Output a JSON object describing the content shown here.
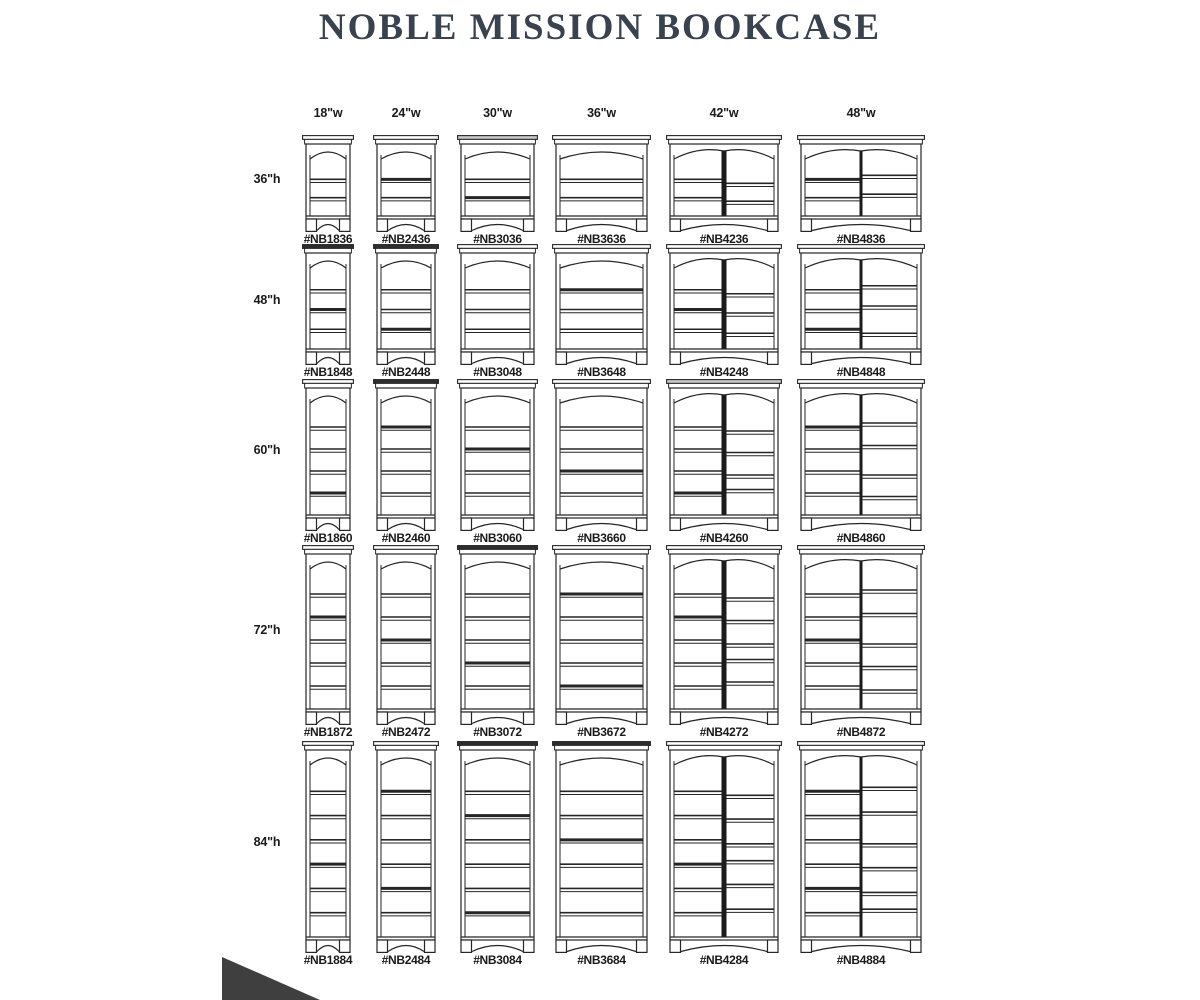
{
  "page": {
    "title": "NOBLE MISSION BOOKCASE",
    "colors": {
      "title": "#39424f",
      "line": "#262626",
      "text": "#1a1a1a",
      "crown_white": "#ffffff",
      "crown_gray": "#c9c9c9",
      "crown_dark": "#2e2e2e",
      "divider": "#1b1b1b",
      "corner_mark": "#3f3f3f",
      "background": "#ffffff"
    }
  },
  "grid": {
    "columns": [
      {
        "label": "18\"w",
        "width_in": 18,
        "divided": false
      },
      {
        "label": "24\"w",
        "width_in": 24,
        "divided": false
      },
      {
        "label": "30\"w",
        "width_in": 30,
        "divided": false
      },
      {
        "label": "36\"w",
        "width_in": 36,
        "divided": false
      },
      {
        "label": "42\"w",
        "width_in": 42,
        "divided": true
      },
      {
        "label": "48\"w",
        "width_in": 48,
        "divided": true
      }
    ],
    "rows": [
      {
        "label": "36\"h",
        "height_in": 36,
        "shelves": 2,
        "models": [
          "#NB1836",
          "#NB2436",
          "#NB3036",
          "#NB3636",
          "#NB4236",
          "#NB4836"
        ]
      },
      {
        "label": "48\"h",
        "height_in": 48,
        "shelves": 3,
        "models": [
          "#NB1848",
          "#NB2448",
          "#NB3048",
          "#NB3648",
          "#NB4248",
          "#NB4848"
        ]
      },
      {
        "label": "60\"h",
        "height_in": 60,
        "shelves": 4,
        "models": [
          "#NB1860",
          "#NB2460",
          "#NB3060",
          "#NB3660",
          "#NB4260",
          "#NB4860"
        ]
      },
      {
        "label": "72\"h",
        "height_in": 72,
        "shelves": 5,
        "models": [
          "#NB1872",
          "#NB2472",
          "#NB3072",
          "#NB3672",
          "#NB4272",
          "#NB4872"
        ]
      },
      {
        "label": "84\"h",
        "height_in": 84,
        "shelves": 6,
        "models": [
          "#NB1884",
          "#NB2484",
          "#NB3084",
          "#NB3684",
          "#NB4284",
          "#NB4884"
        ]
      }
    ],
    "crown_shades": [
      [
        "w",
        "w",
        "g",
        "w",
        "w",
        "w"
      ],
      [
        "k",
        "k",
        "w",
        "w",
        "w",
        "w"
      ],
      [
        "w",
        "k",
        "w",
        "w",
        "g",
        "w"
      ],
      [
        "w",
        "w",
        "k",
        "w",
        "w",
        "w"
      ],
      [
        "w",
        "w",
        "k",
        "k",
        "w",
        "w"
      ]
    ]
  }
}
